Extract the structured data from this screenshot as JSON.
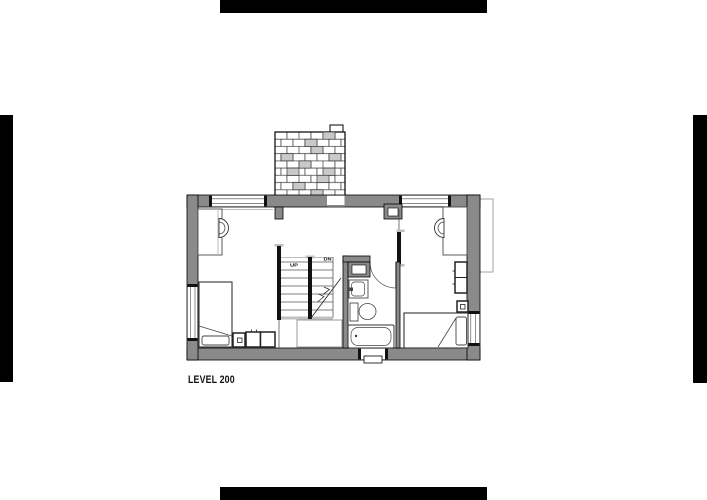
{
  "title": {
    "label": "LEVEL 200"
  },
  "plan": {
    "stairs": {
      "up_label": "UP",
      "down_label": "DN"
    }
  },
  "colors": {
    "background": "#ffffff",
    "registration_mark": "#000000",
    "wall_fill": "#8a8a8a",
    "line_light": "#bdbdbd",
    "landing_gray": "#c0c0c0",
    "brick_shade": "#c9c9c9"
  }
}
